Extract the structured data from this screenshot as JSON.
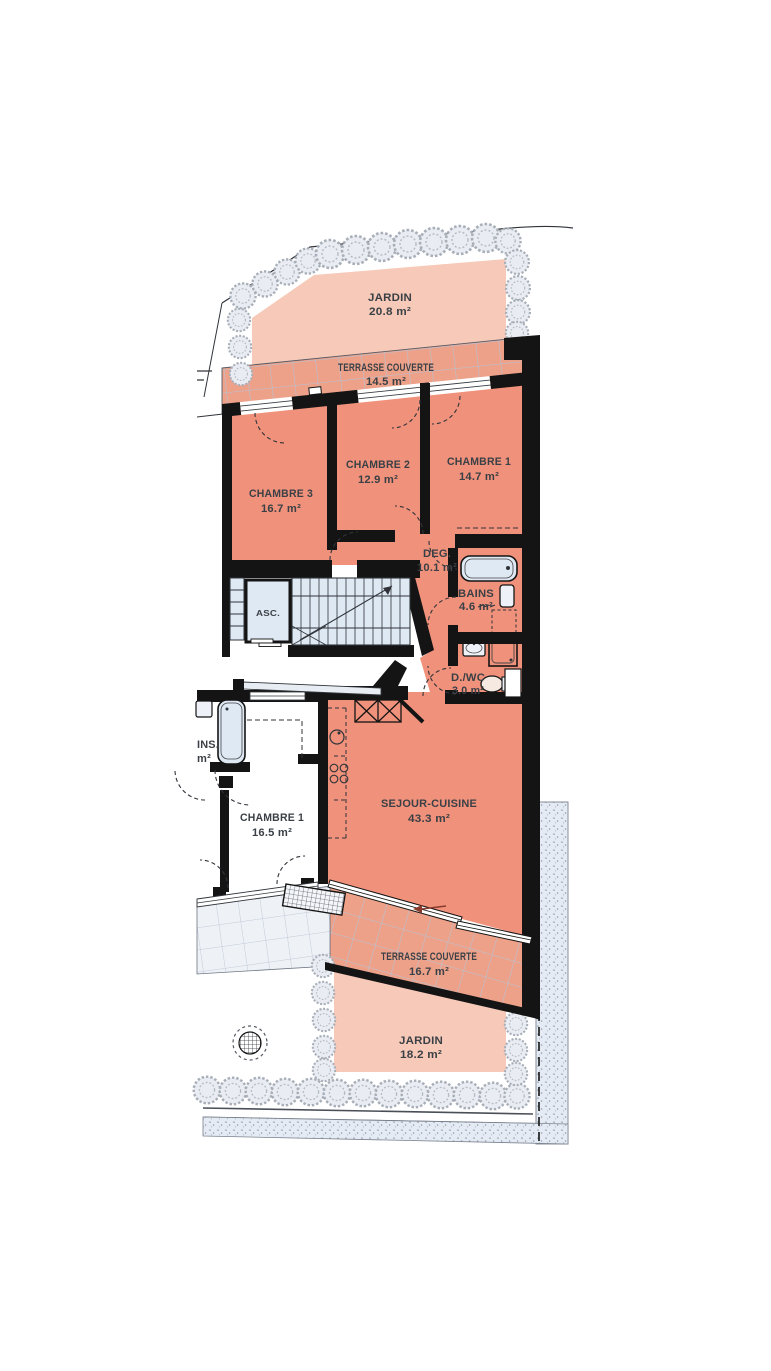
{
  "plan": {
    "unit_rooms": {
      "chambre3": {
        "name": "CHAMBRE 3",
        "area": "16.7 m²"
      },
      "chambre2": {
        "name": "CHAMBRE 2",
        "area": "12.9 m²"
      },
      "chambre1": {
        "name": "CHAMBRE 1",
        "area": "14.7 m²"
      },
      "degagement": {
        "name": "DEG.",
        "area": "10.1 m²"
      },
      "bains": {
        "name": "BAINS",
        "area": "4.6 m²"
      },
      "douche_wc": {
        "name": "D./WC",
        "area": "3.0 m²"
      },
      "sejour_cuisine": {
        "name": "SEJOUR-CUISINE",
        "area": "43.3 m²"
      }
    },
    "outdoor": {
      "jardin_top": {
        "name": "JARDIN",
        "area": "20.8 m²"
      },
      "terrasse_top": {
        "name": "TERRASSE COUVERTE",
        "area": "14.5 m²"
      },
      "terrasse_bottom": {
        "name": "TERRASSE COUVERTE",
        "area": "16.7 m²"
      },
      "jardin_bottom": {
        "name": "JARDIN",
        "area": "18.2 m²"
      }
    },
    "neighbor_unit": {
      "chambre1": {
        "name": "CHAMBRE 1",
        "area": "16.5 m²"
      },
      "bains_clipped": {
        "name": "INS.",
        "area": "m²"
      }
    },
    "circulation": {
      "elevator": {
        "name": "ASC."
      }
    },
    "colors": {
      "room_fill": "#F0917B",
      "terrace_fill": "#EDA189",
      "garden_fill": "#F7C9B8",
      "fixture_fill": "#DFE9F4",
      "wall": "#141414",
      "hedge": "#A9AFB9",
      "tile_grid": "#B7C3D6",
      "text": "#3A4045"
    }
  }
}
